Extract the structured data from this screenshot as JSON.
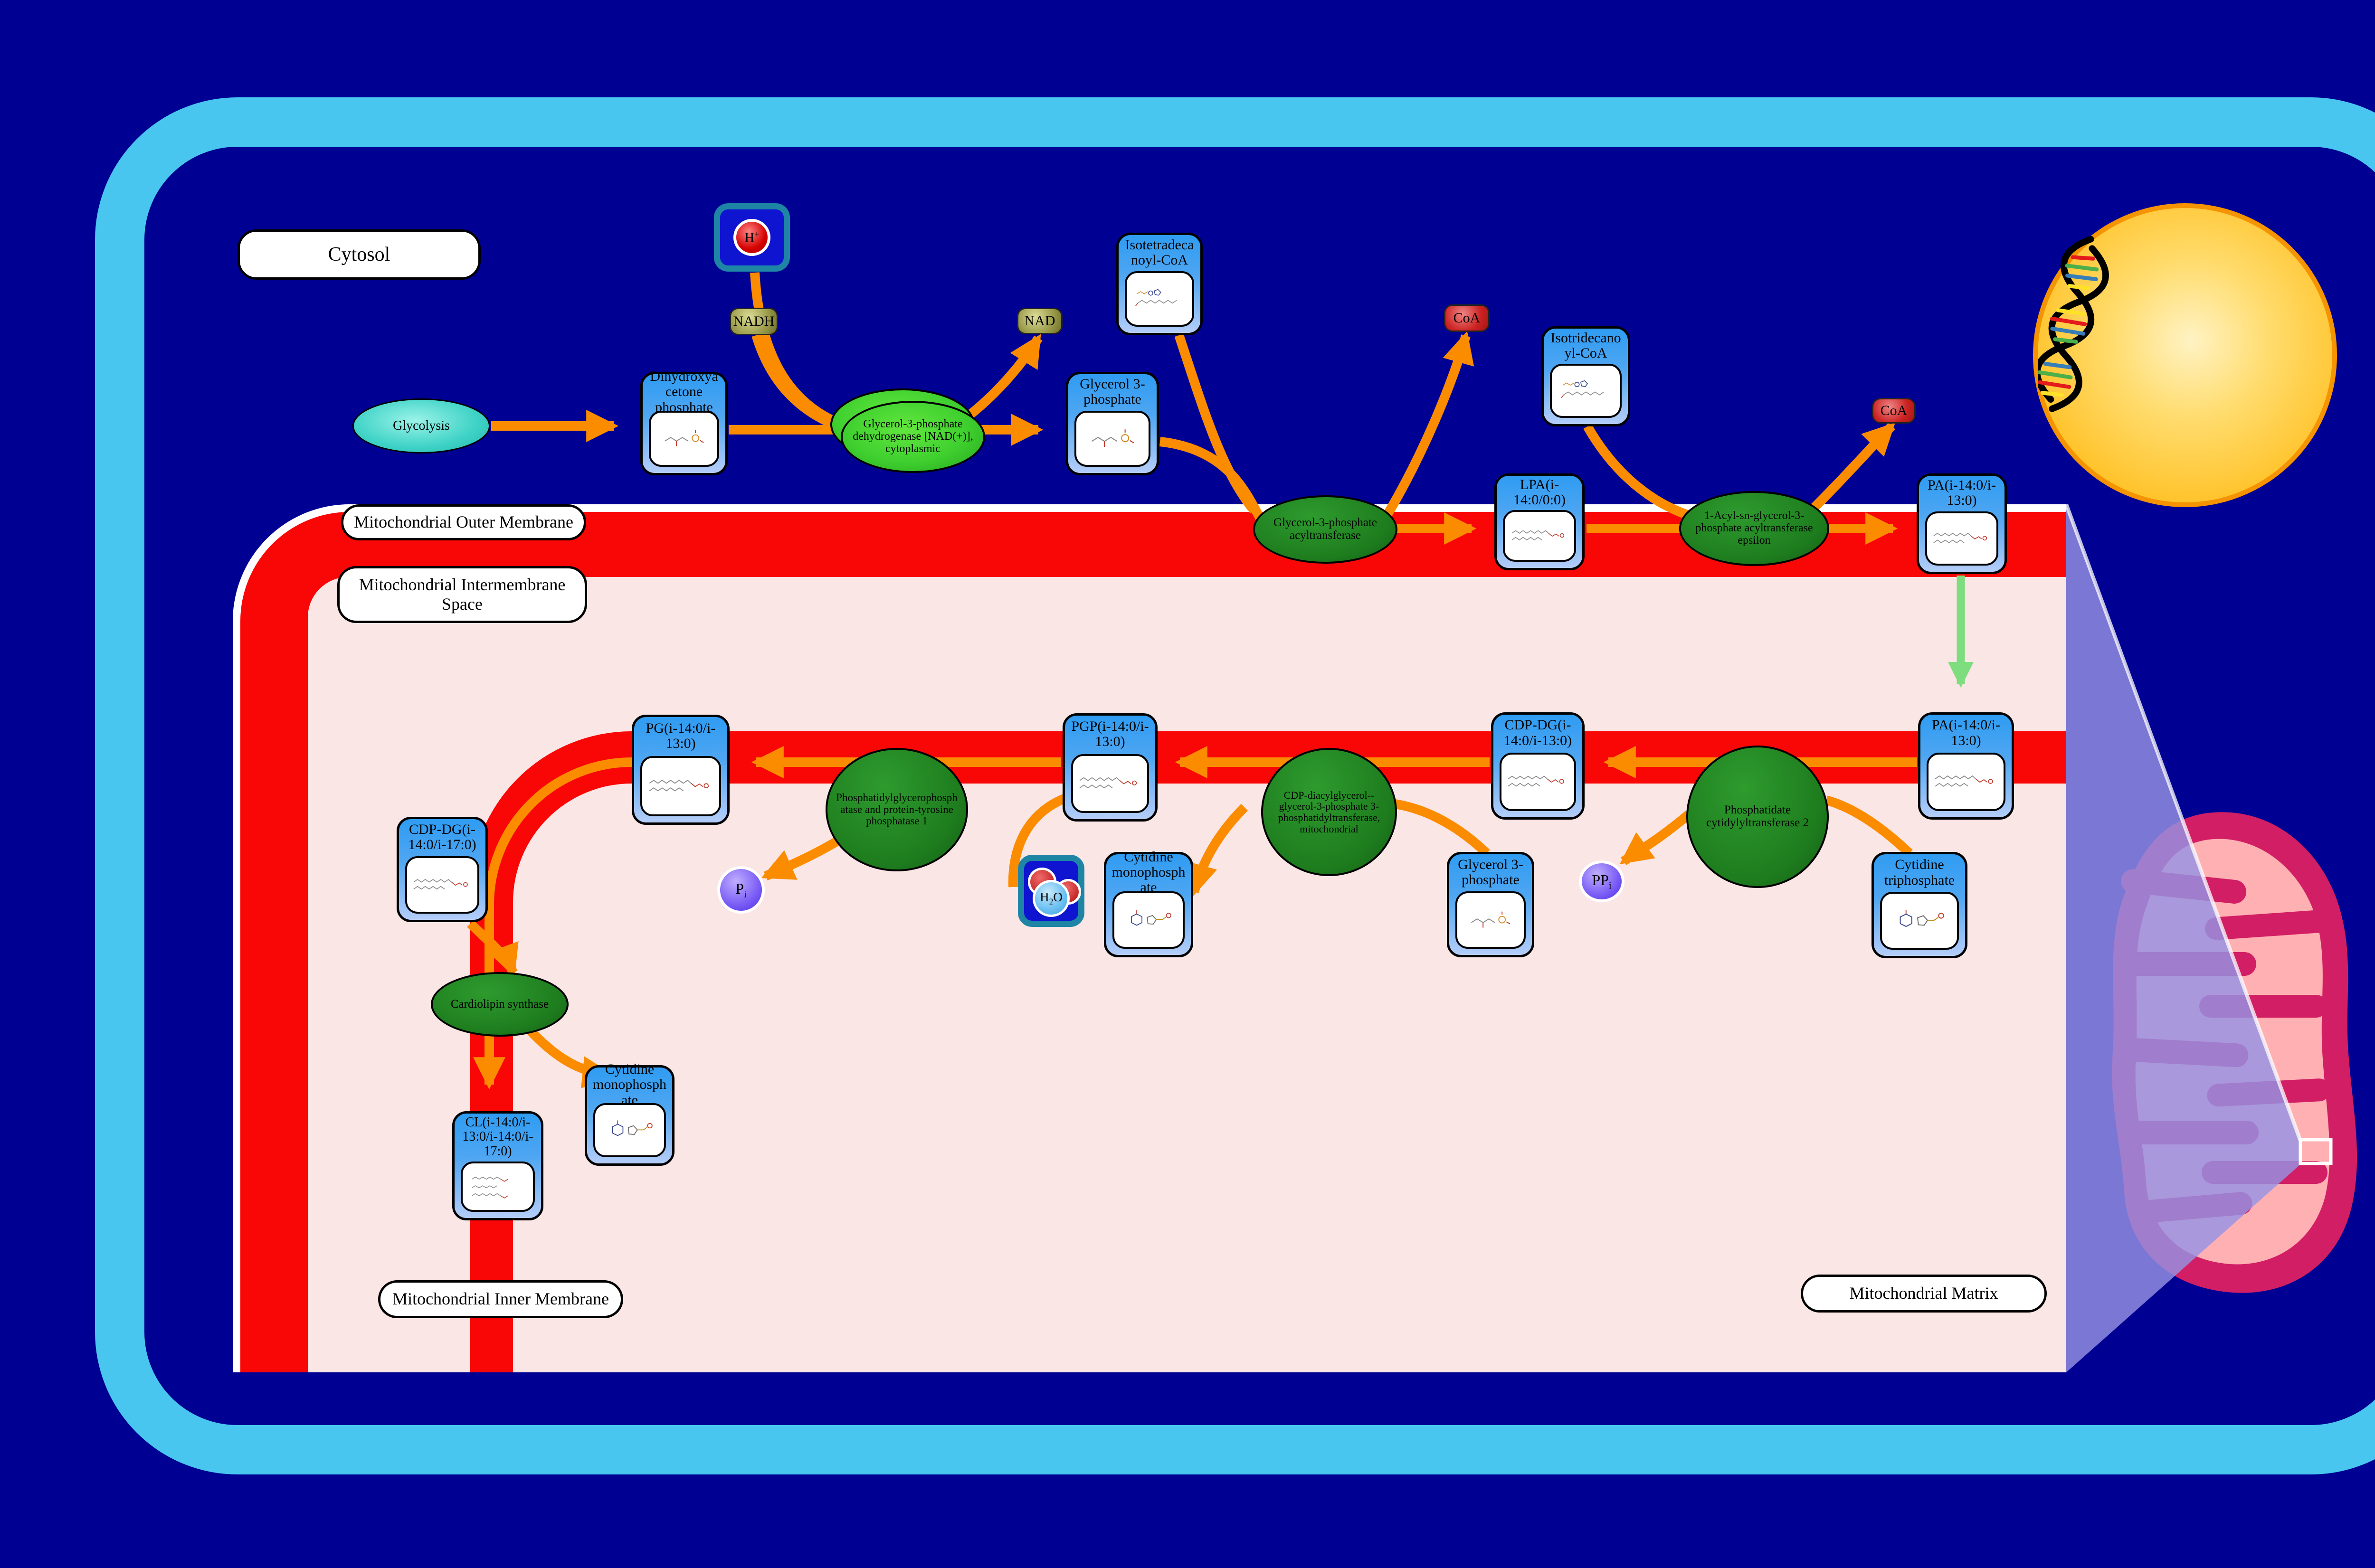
{
  "labels": {
    "cytosol": "Cytosol",
    "outer_membrane": "Mitochondrial Outer Membrane",
    "intermembrane_space": "Mitochondrial Intermembrane Space",
    "inner_membrane": "Mitochondrial Inner Membrane",
    "matrix": "Mitochondrial Matrix"
  },
  "pathway_links": {
    "glycolysis": "Glycolysis"
  },
  "enzymes": {
    "gpd1": "Glycerol-3-phosphate dehydrogenase [NAD(+)], cytoplasmic",
    "gpat": "Glycerol-3-phosphate acyltransferase",
    "agpat": "1-Acyl-sn-glycerol-3-phosphate acyltransferase epsilon",
    "pcyt2": "Phosphatidate cytidylyltransferase 2",
    "cds": "CDP-diacylglycerol--glycerol-3-phosphate 3-phosphatidyltransferase, mitochondrial",
    "ptpmt1": "Phosphatidylglycerophosphatase and protein-tyrosine phosphatase 1",
    "crls": "Cardiolipin synthase"
  },
  "metabolites": {
    "dhap": "Dihydroxyacetone phosphate",
    "g3p_cytosol": "Glycerol 3-phosphate",
    "iso14_coa": "Isotetradecanoyl-CoA",
    "iso13_coa": "Isotridecanoyl-CoA",
    "lpa": "LPA(i-14:0/0:0)",
    "pa_outer": "PA(i-14:0/i-13:0)",
    "pa_inner": "PA(i-14:0/i-13:0)",
    "cdpdg": "CDP-DG(i-14:0/i-13:0)",
    "pgp": "PGP(i-14:0/i-13:0)",
    "pg": "PG(i-14:0/i-13:0)",
    "cdpdg17": "CDP-DG(i-14:0/i-17:0)",
    "cl": "CL(i-14:0/i-13:0/i-14:0/i-17:0)",
    "cmp_a": "Cytidine monophosphate",
    "cmp_b": "Cytidine monophosphate",
    "g3p_matrix": "Glycerol 3-phosphate",
    "ctp": "Cytidine triphosphate"
  },
  "cofactors": {
    "nadh": "NADH",
    "nad": "NAD",
    "coa_1": "CoA",
    "coa_2": "CoA",
    "h_plus": {
      "base": "H",
      "sup": "+"
    },
    "pi": {
      "base": "P",
      "sub": "i"
    },
    "ppi": {
      "base": "PP",
      "sub": "i"
    },
    "h2o": {
      "h": "H",
      "two": "2",
      "o": "O"
    }
  },
  "colors": {
    "background": "#000092",
    "cell_border": "#48C6EF",
    "membrane_red": "#F90606",
    "pink": "#FBE6E6",
    "arrow": "#FB8C00",
    "green_arrow": "#7EDD7E",
    "box_blue": "#2F9CF2",
    "box_blue_light": "#B4CDF9",
    "enzyme_green": "#1E7D1E",
    "enzyme_green_bright": "#3FD02F",
    "glycolysis_teal": "#3ED2C6",
    "nucleus_yellow": "#FFC228",
    "mito_body": "#D21E64",
    "mito_cristae": "#FFB0B2",
    "beam_purple": "#9691E0",
    "nad_olive": "#9A9A4A",
    "coa_red": "#CC2222",
    "phosphate_purple": "#7A5CF5",
    "water_blue": "#0F14D0"
  }
}
